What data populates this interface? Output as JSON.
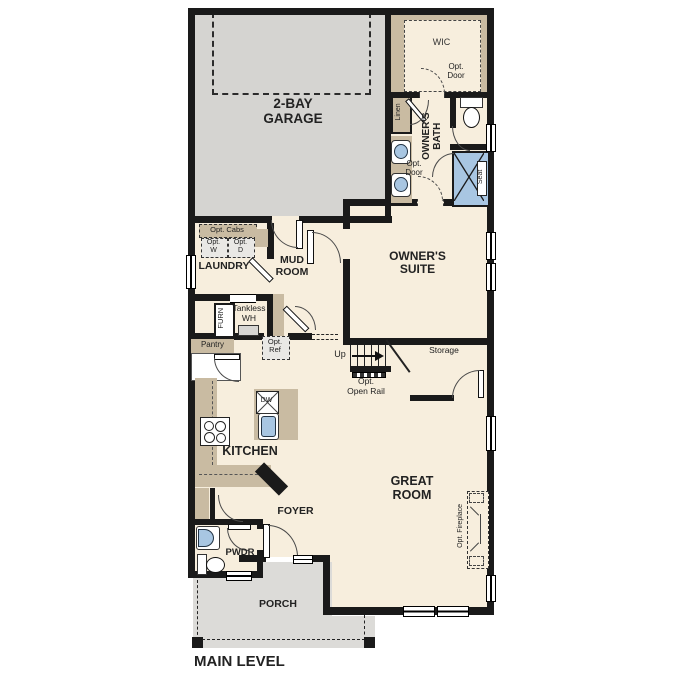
{
  "plan_title": "MAIN LEVEL",
  "rooms": {
    "garage": "2-BAY\nGARAGE",
    "wic": "WIC",
    "owners_bath": "OWNER'S\nBATH",
    "owners_suite": "OWNER'S\nSUITE",
    "laundry": "LAUNDRY",
    "mud_room": "MUD\nROOM",
    "kitchen": "KITCHEN",
    "great_room": "GREAT\nROOM",
    "foyer": "FOYER",
    "pwdr": "PWDR",
    "porch": "PORCH",
    "storage": "Storage",
    "pantry": "Pantry",
    "linen": "Linen"
  },
  "features": {
    "opt_cabs": "Opt. Cabs",
    "opt_washer": "Opt.\nW",
    "opt_dryer": "Opt.\nD",
    "furnace": "FURN",
    "tankless_wh": "Tankless\nWH",
    "opt_ref": "Opt.\nRef",
    "dishwasher": "DW",
    "up": "Up",
    "opt_open_rail": "Opt.\nOpen Rail",
    "opt_fireplace": "Opt. Fireplace",
    "seat": "Seat",
    "wic_opt_door": "Opt.\nDoor",
    "bath_opt_door": "Opt.\nDoor"
  },
  "colors": {
    "wall": "#1a1a1a",
    "floor_cream": "#f7eedd",
    "garage_gray": "#d5d4d1",
    "porch_gray": "#dcdbd8",
    "cabinet_tan": "#c9bba2",
    "fixture_blue": "#a8c6e2"
  }
}
